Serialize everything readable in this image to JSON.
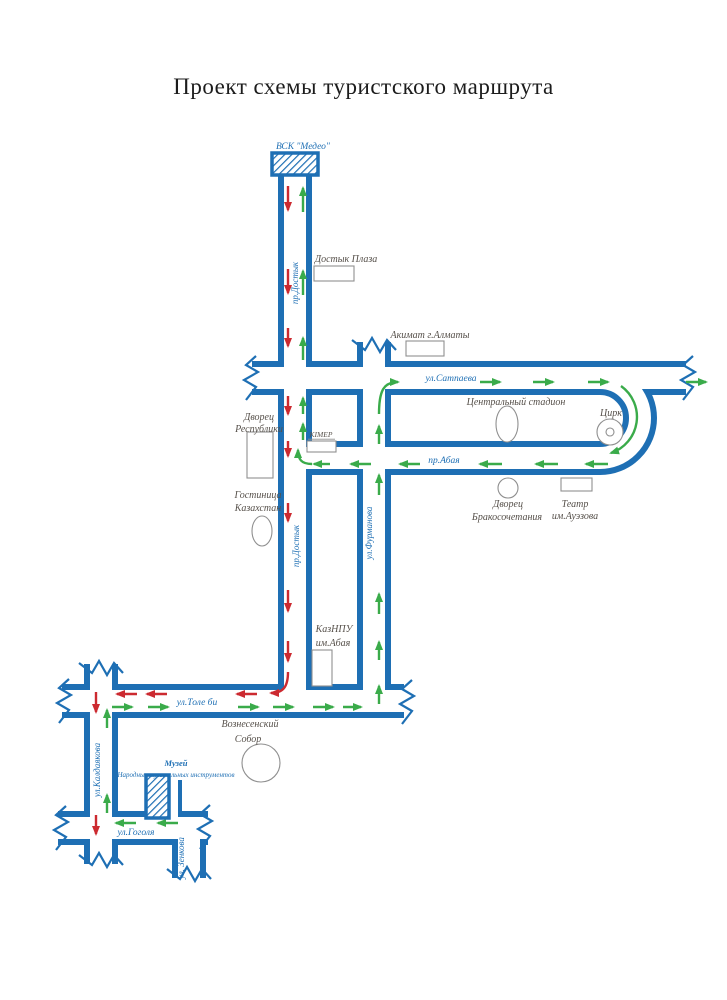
{
  "title": "Проект схемы туристского маршрута",
  "colors": {
    "road_blue": "#1e6fb4",
    "route_green_arrows": "#3aab4a",
    "route_red_arrows": "#cc2a30",
    "building_outline": "#8f8f8f",
    "place_label": "#56504a",
    "street_label": "#1e6fb4"
  },
  "terminals": {
    "medeo_label": "ВСК \"Медео\"",
    "museum_label1": "Музей",
    "museum_label2": "Народных музыкальных инструментов"
  },
  "streets": {
    "dostyk": "пр.Достык",
    "dostyk2": "пр.Достык",
    "satpaeva": "ул.Сатпаева",
    "abaya": "пр.Абая",
    "furmanova": "ул.Фурманова",
    "tole_bi": "ул.Толе би",
    "kaldayakova": "ул.Калдаякова",
    "gogolya": "ул.Гоголя",
    "zenkova": "ул. Зенкова"
  },
  "places": {
    "dostyk_plaza": "Достык Плаза",
    "akimat": "Акимат г.Алматы",
    "stadium": "Центральный стадион",
    "circus": "Цирк",
    "palace_republic1": "Дворец",
    "palace_republic2": "Республики",
    "kimep": "KIMEP",
    "hotel1": "Гостиница",
    "hotel2": "Казахстан",
    "wedding1": "Дворец",
    "wedding2": "Бракосочетания",
    "theatre1": "Театр",
    "theatre2": "им.Ауэзова",
    "kaznpu1": "КазНПУ",
    "kaznpu2": "им.Абая",
    "cathedral1": "Вознесенский",
    "cathedral2": "Собор"
  }
}
